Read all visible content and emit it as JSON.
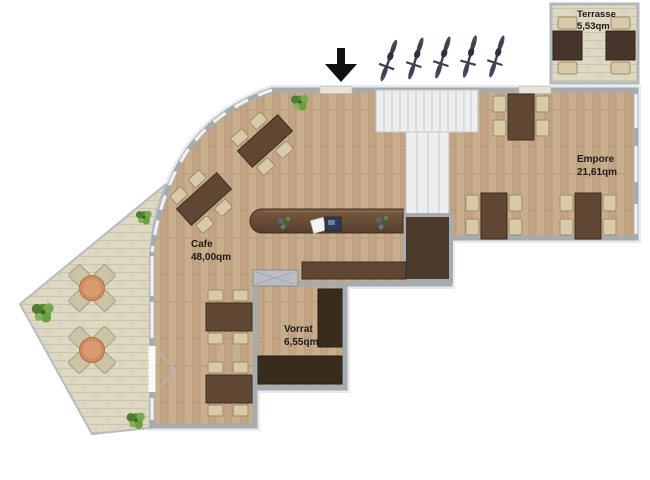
{
  "rooms": {
    "terrasse": {
      "name": "Terrasse",
      "area": "5,53qm"
    },
    "empore": {
      "name": "Empore",
      "area": "21,61qm"
    },
    "cafe": {
      "name": "Cafe",
      "area": "48,00qm"
    },
    "vorrat": {
      "name": "Vorrat",
      "area": "6,55qm"
    }
  },
  "colors": {
    "wall": "#a6abb0",
    "wood_floor": "#c9ae8e",
    "tile": "#ded8c2",
    "dark_wood": "#5f4734",
    "chair": "#d8c9a8",
    "shelf": "#382c1f",
    "stairs": "#eceef0",
    "plant": "#5c8e3a",
    "accent_table": "#ce8d61",
    "bike": "#39424e",
    "arrow": "#111111",
    "label": "#1d1c1a"
  },
  "icons": {
    "entrance_arrow": "black arrow pointing down at entrance door",
    "bicycle_icon": "top-view parked bicycle",
    "plant_icon": "green shrub"
  },
  "furniture": {
    "cafe_tables": 4,
    "empore_tables": 3,
    "terrasse_tables": 2,
    "outdoor_seating_groups": 2,
    "bicycles": 5,
    "plants": 4
  }
}
